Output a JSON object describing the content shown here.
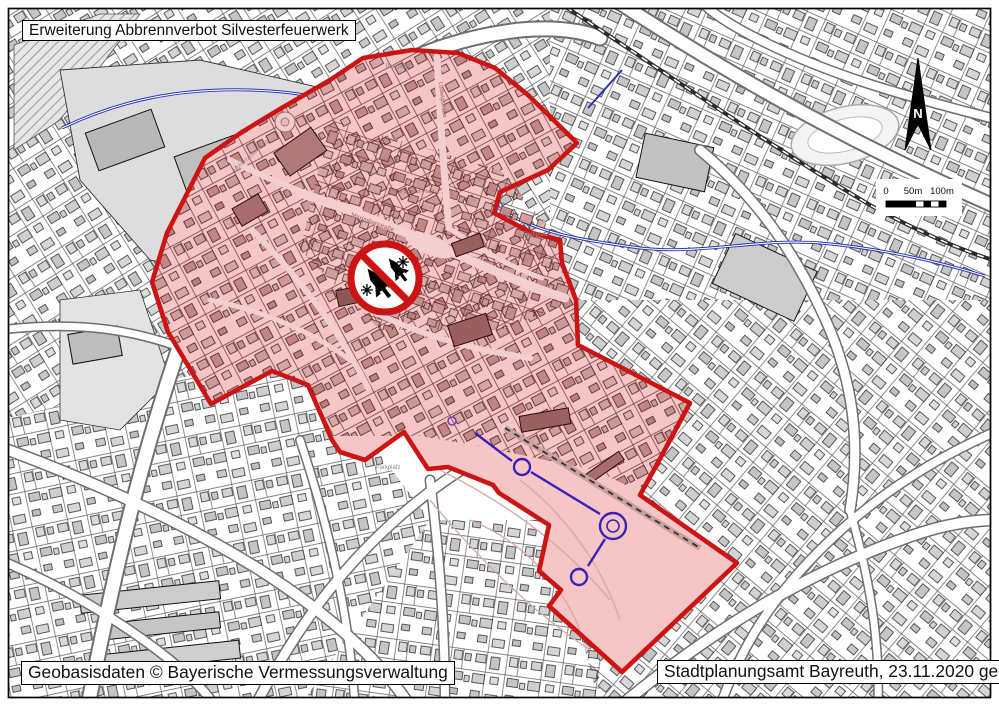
{
  "page": {
    "title_box": "Erweiterung Abbrennverbot Silvesterfeuerwerk",
    "credit_box": "Geobasisdaten © Bayerische Vermessungsverwaltung",
    "source_box": "Stadtplanungsamt Bayreuth, 23.11.2020 ge"
  },
  "map": {
    "kind": "city-plan-with-prohibition-zone",
    "city": "Bayreuth",
    "zone": {
      "meaning": "Abbrennverbot Silvesterfeuerwerk Zone",
      "fill": "#f6c5c5",
      "border": "#cc1414",
      "boundary_points": "363,58 412,50 458,53 495,68 528,95 577,143 548,170 500,192 494,213 532,233 560,240 562,263 576,300 578,345 690,403 655,468 640,495 737,563 622,672 549,606 561,590 539,571 549,525 499,493 493,485 448,467 428,469 404,432 365,460 340,452 332,440 308,385 272,371 211,404 180,352 168,332 152,282 167,233 205,158 242,132 280,109 330,80",
      "town_points": "363,58 412,50 458,53 495,68 528,95 577,143 548,170 500,192 494,213 532,233 560,240 562,263 576,300 578,345 690,403 655,468 640,492 595,470 545,460 480,446 420,436 330,436 308,385 272,371 211,404 180,352 168,332 152,282 167,233 205,158 242,132 280,109 330,80"
    },
    "colors": {
      "water": "#2a35b5",
      "canal": "#3a22b8",
      "building_gray": "#c9c9c9",
      "building_rose": "#c79191",
      "sign_red": "#cc1414"
    },
    "north_label": "N",
    "scale": {
      "labels": [
        "0",
        "50m",
        "100m"
      ]
    },
    "labels": [
      {
        "text": "Hohenzollernring",
        "x": 252,
        "y": 157,
        "rot": -42,
        "size": 6,
        "color": "#8a8a8a"
      },
      {
        "text": "Parkplatz",
        "x": 536,
        "y": 236,
        "rot": 0,
        "size": 6,
        "color": "#8a8a8a"
      },
      {
        "text": "Parkplatz",
        "x": 388,
        "y": 469,
        "rot": 0,
        "size": 6,
        "color": "#8a8a8a"
      },
      {
        "text": "Parkplatz",
        "x": 398,
        "y": 68,
        "rot": 0,
        "size": 6,
        "color": "#8a8a8a"
      },
      {
        "text": "Kirchplatz",
        "x": 338,
        "y": 294,
        "rot": 0,
        "size": 5.5,
        "color": "#9c5a5a"
      },
      {
        "text": "La-Spezia-Platz",
        "x": 415,
        "y": 193,
        "rot": 0,
        "size": 5.5,
        "color": "#9c5a5a"
      },
      {
        "text": "Ludwigstraße",
        "x": 441,
        "y": 100,
        "rot": 83,
        "size": 6,
        "color": "#9c5a5a"
      },
      {
        "text": "Maximilianstraße",
        "x": 372,
        "y": 224,
        "rot": 20,
        "size": 6,
        "color": "#9c5a5a"
      }
    ]
  }
}
